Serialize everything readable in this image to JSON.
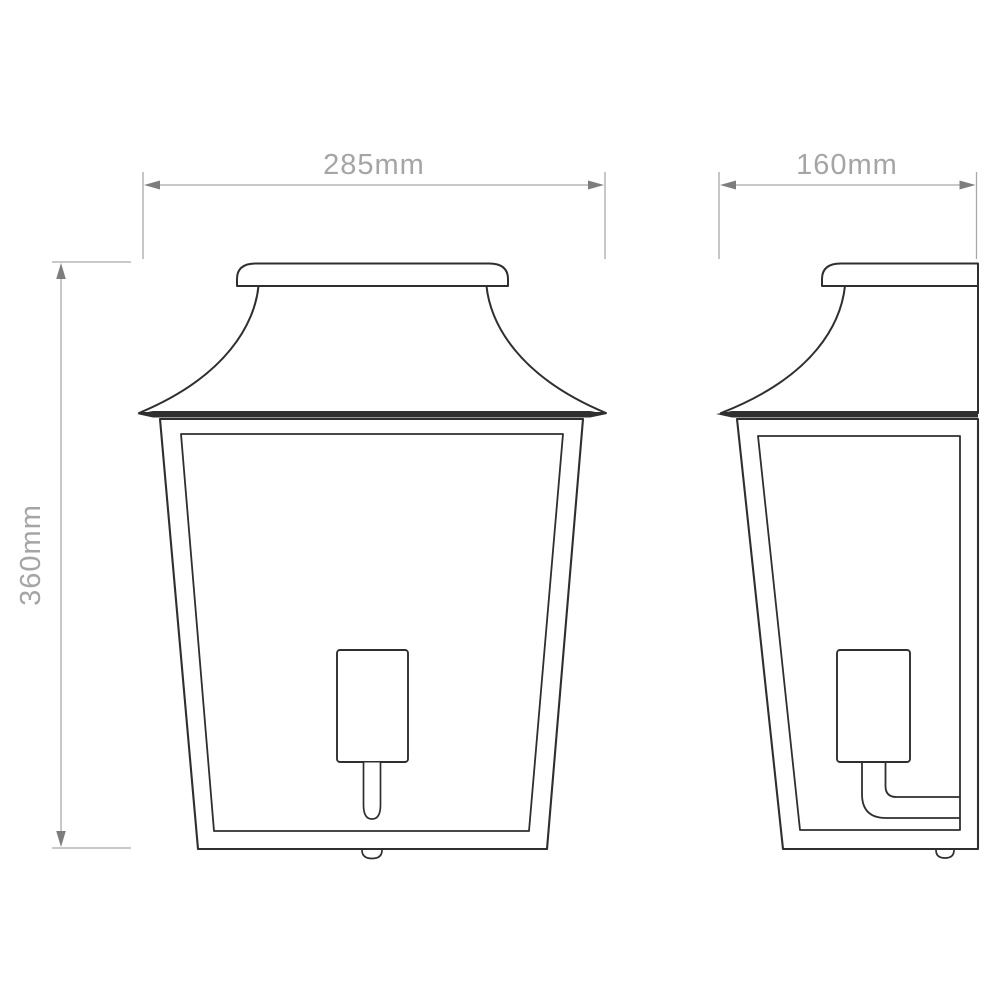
{
  "drawing": {
    "type": "technical-dimension-drawing",
    "subject": "wall lantern, front and side elevation",
    "background_color": "#ffffff",
    "outline_color": "#2f2f2f",
    "dimension_line_color": "#a9a9a9",
    "dimension_arrow_color": "#7d7d7d",
    "dimension_text_color": "#a5a5a5",
    "dimensions": {
      "front_width": {
        "label": "285mm",
        "value_mm": 285
      },
      "side_depth": {
        "label": "160mm",
        "value_mm": 160
      },
      "height": {
        "label": "360mm",
        "value_mm": 360
      }
    }
  }
}
